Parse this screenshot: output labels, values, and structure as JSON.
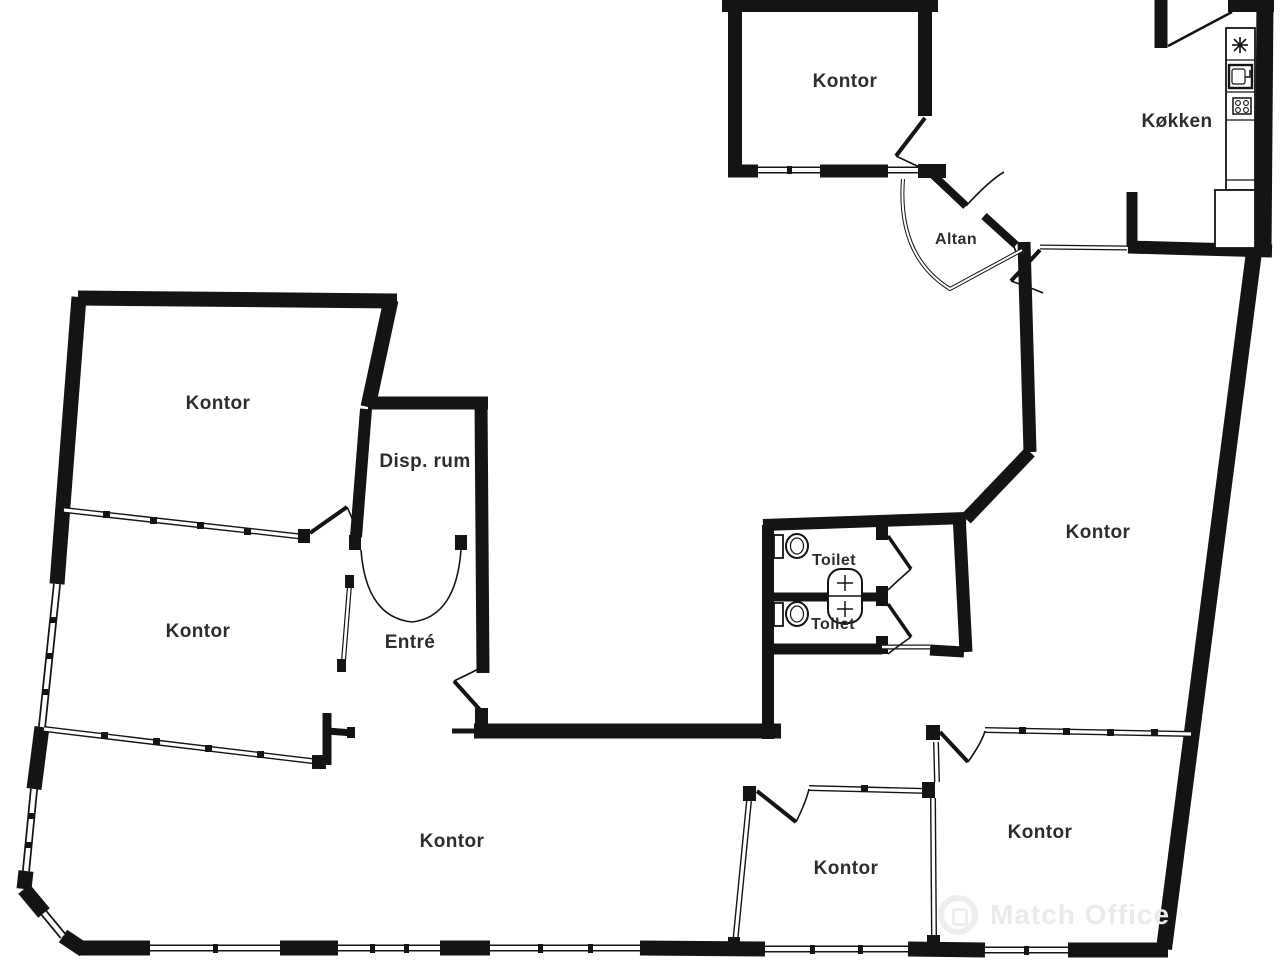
{
  "title": "Office floor plan",
  "colors": {
    "wall": "#141414",
    "background": "#ffffff",
    "label_text": "#2d2d2d",
    "watermark": "#ebebeb"
  },
  "rooms": [
    {
      "id": "kontor-top-right",
      "label": "Kontor",
      "x": 845,
      "y": 82,
      "small": false
    },
    {
      "id": "kokken",
      "label": "Køkken",
      "x": 1177,
      "y": 122,
      "small": false
    },
    {
      "id": "altan",
      "label": "Altan",
      "x": 956,
      "y": 240,
      "small": true
    },
    {
      "id": "kontor-top-left",
      "label": "Kontor",
      "x": 218,
      "y": 404,
      "small": false
    },
    {
      "id": "disp-rum",
      "label": "Disp. rum",
      "x": 425,
      "y": 462,
      "small": false
    },
    {
      "id": "kontor-mid-left",
      "label": "Kontor",
      "x": 198,
      "y": 632,
      "small": false
    },
    {
      "id": "entre",
      "label": "Entré",
      "x": 410,
      "y": 643,
      "small": false
    },
    {
      "id": "toilet-top",
      "label": "Toilet",
      "x": 834,
      "y": 561,
      "small": true
    },
    {
      "id": "toilet-bottom",
      "label": "Toilet",
      "x": 833,
      "y": 625,
      "small": true
    },
    {
      "id": "kontor-right",
      "label": "Kontor",
      "x": 1098,
      "y": 533,
      "small": false
    },
    {
      "id": "kontor-bottom-large",
      "label": "Kontor",
      "x": 452,
      "y": 842,
      "small": false
    },
    {
      "id": "kontor-bottom-middle",
      "label": "Kontor",
      "x": 846,
      "y": 869,
      "small": false
    },
    {
      "id": "kontor-bottom-right",
      "label": "Kontor",
      "x": 1040,
      "y": 833,
      "small": false
    }
  ],
  "fixtures": [
    {
      "id": "toilet-top-fixture",
      "icon": "toilet-icon"
    },
    {
      "id": "toilet-bottom-fixture",
      "icon": "toilet-icon"
    },
    {
      "id": "shared-basin",
      "icon": "sink-basin-icon"
    },
    {
      "id": "kitchen-freezer",
      "icon": "snowflake-icon"
    },
    {
      "id": "kitchen-sink",
      "icon": "kitchen-sink-icon"
    },
    {
      "id": "kitchen-stove",
      "icon": "stove-icon"
    },
    {
      "id": "kitchen-counter",
      "icon": "counter-outline"
    }
  ],
  "watermark": {
    "text": "Match Office",
    "logo": "match-office-logo-icon"
  }
}
